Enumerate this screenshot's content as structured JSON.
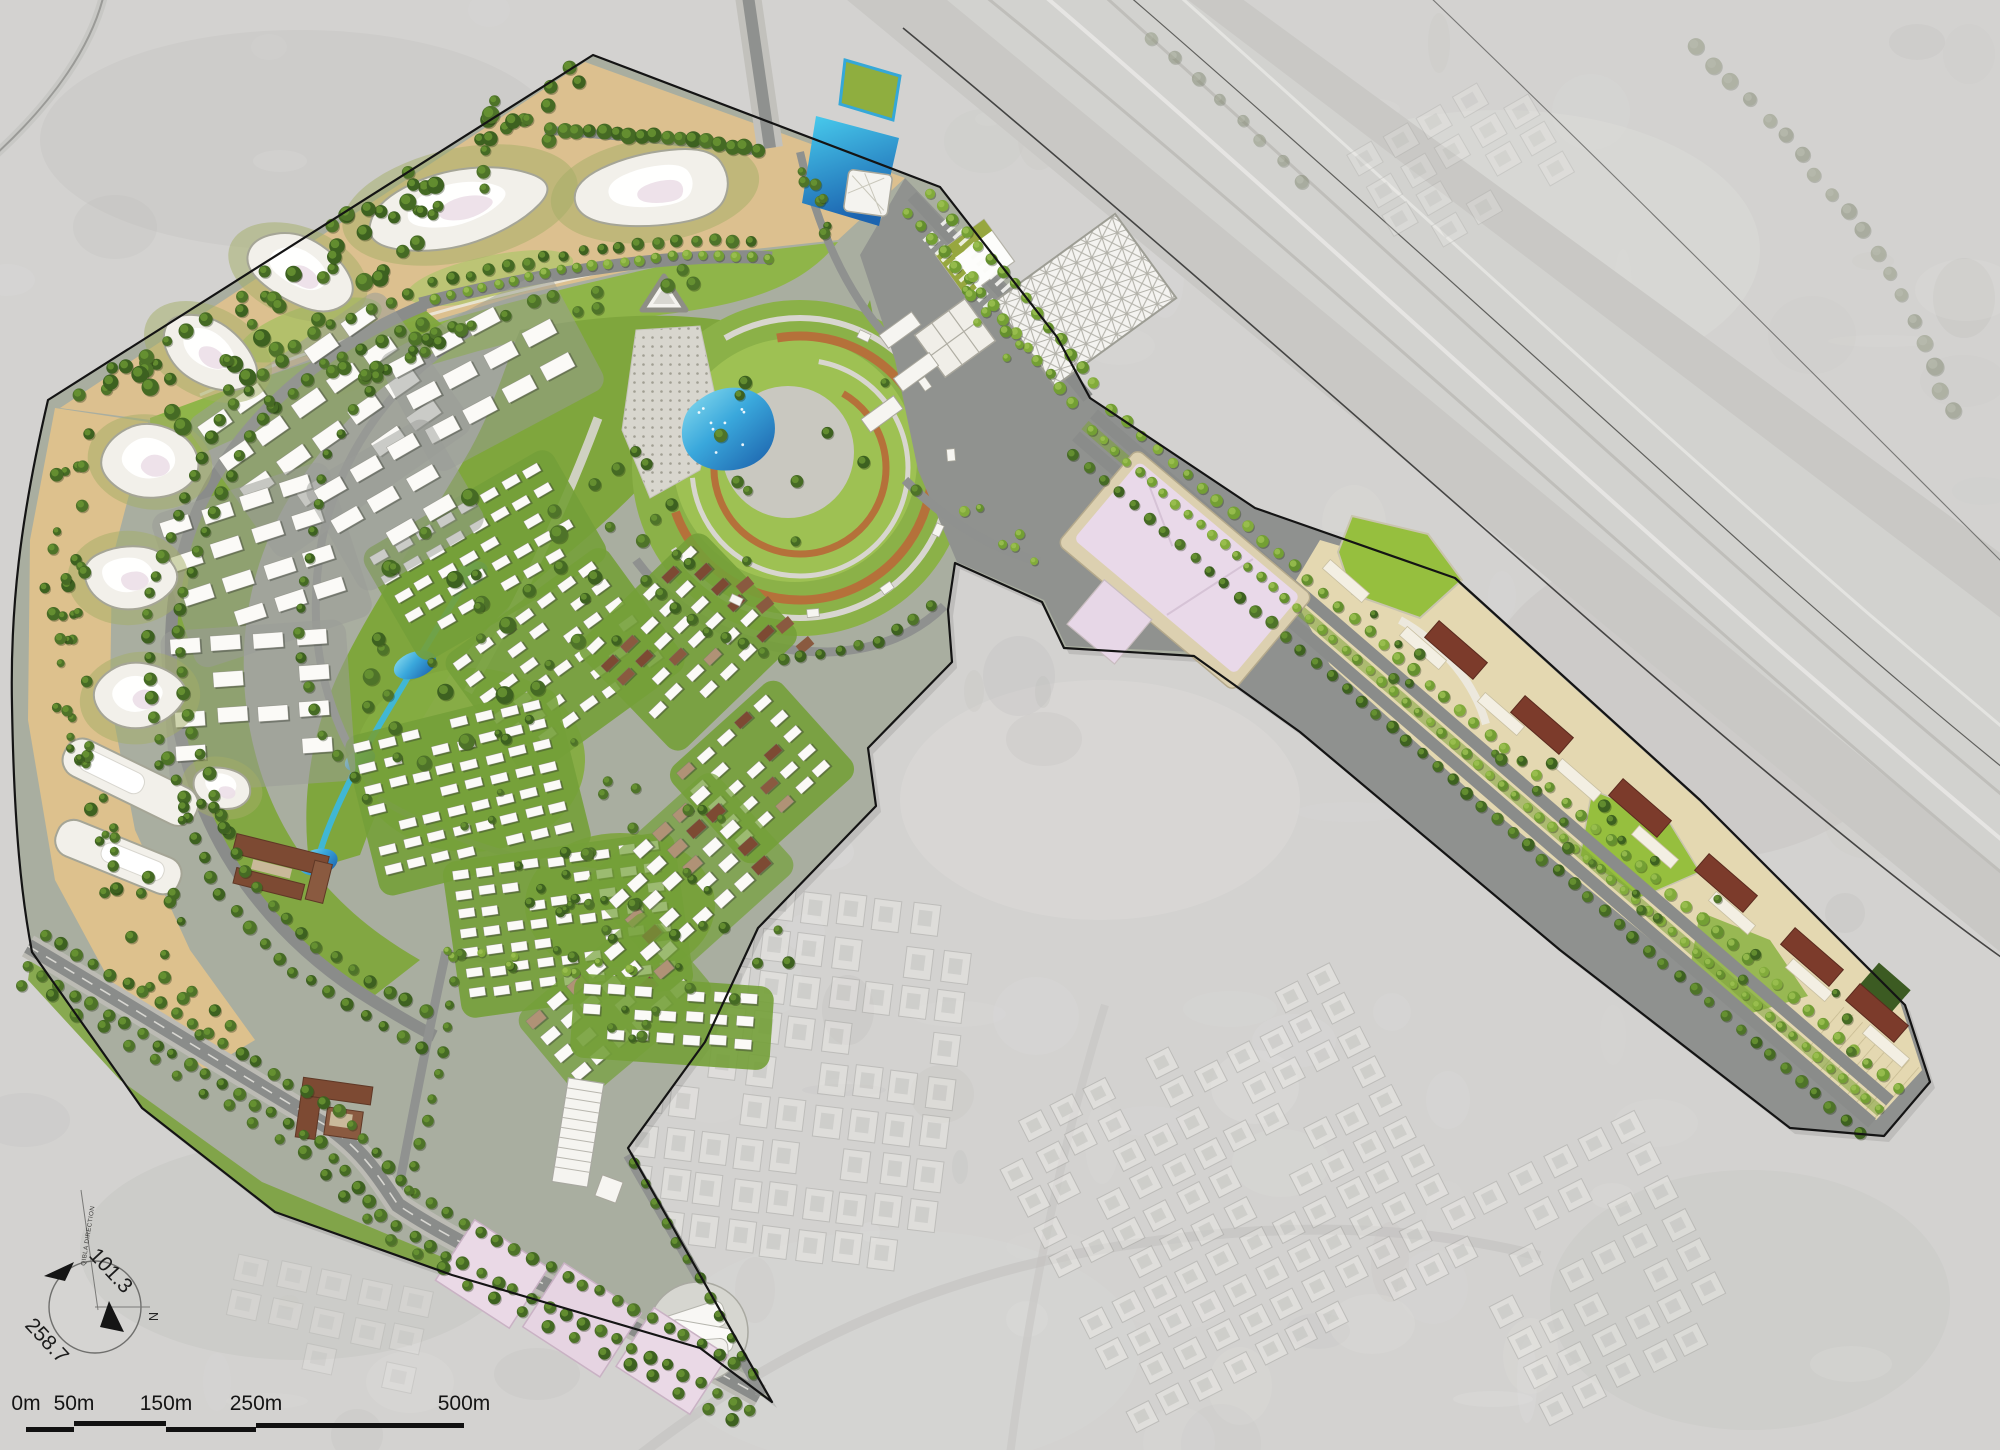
{
  "map": {
    "kind": "masterplan-aerial-site-plan",
    "compass": {
      "bearing_ne": "101.3",
      "bearing_sw": "258.7",
      "north_label": "N",
      "qibla_label": "QIBLA DIRECTION"
    },
    "scale_bar": {
      "labels": [
        "0m",
        "50m",
        "150m",
        "250m",
        "500m"
      ]
    },
    "palette": {
      "satellite": "#d3d2d0",
      "asphalt": "#8b8d8b",
      "sidewalk": "#c4c3bd",
      "lawn": "#7fa63d",
      "lawn_bright": "#96bf3e",
      "tree": "#456a24",
      "street_tree": "#739f34",
      "sand": "#dcc08f",
      "water": "#39b2da",
      "water_deep": "#1d6cb0",
      "building_white": "#f4f2ec",
      "retail_pink": "#e8d8e8",
      "plot_beige": "#e4d8b1",
      "roof_brown": "#7d4a33",
      "boundary": "#141414"
    },
    "icons": {
      "compass": "qibla-compass-icon",
      "north_arrow": "north-arrow-icon"
    }
  }
}
